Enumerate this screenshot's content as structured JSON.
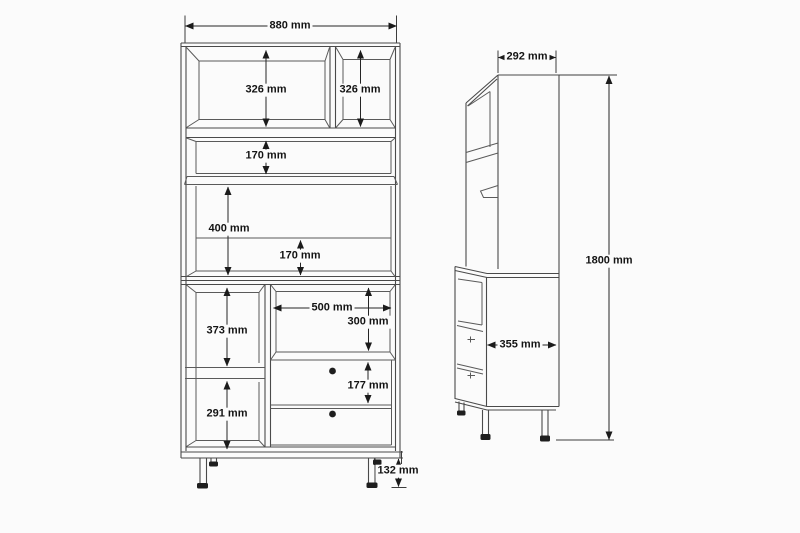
{
  "front_view": {
    "dimensions": {
      "overall_width": "880 mm",
      "top_left_compartment_height": "326 mm",
      "top_right_compartment_height": "326 mm",
      "middle_shelf_height": "170 mm",
      "open_section_height": "400 mm",
      "open_section_lower_height": "170 mm",
      "lower_left_upper_height": "373 mm",
      "lower_left_lower_height": "291 mm",
      "niche_width": "500 mm",
      "niche_height": "300 mm",
      "drawer_height": "177 mm",
      "leg_height": "132 mm"
    }
  },
  "side_view": {
    "dimensions": {
      "upper_depth": "292 mm",
      "lower_depth": "355 mm",
      "overall_height": "1800 mm"
    }
  }
}
